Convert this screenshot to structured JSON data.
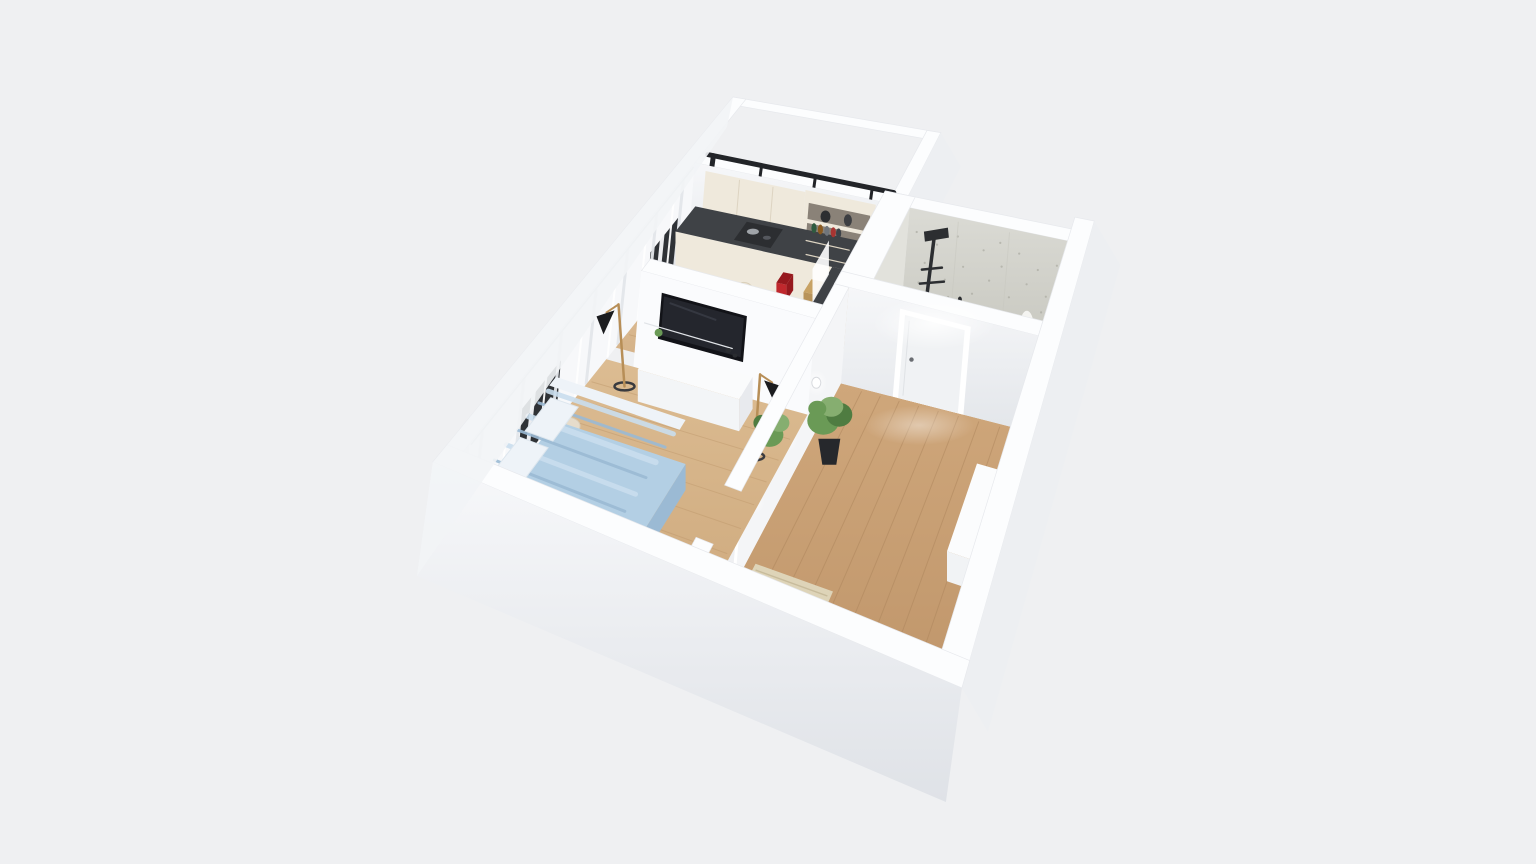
{
  "app": {
    "title": "3D apartment floor plan render",
    "view": "dollhouse-perspective",
    "background": "#eff0f2"
  },
  "scene": {
    "rooms": [
      {
        "id": "balcony",
        "name": "Balcony",
        "items": [
          "glass-wall-frame",
          "window-mullions",
          "balcony-floor",
          "small-dark-object"
        ]
      },
      {
        "id": "kitchen",
        "name": "Kitchen / Dining",
        "items": [
          "upper-cabinets",
          "open-shelf-unit",
          "range-hood",
          "cooktop",
          "red-kettle",
          "spice-rack",
          "dark-countertop",
          "drawer-cabinets",
          "side-counter",
          "dining-table",
          "placemats",
          "dining-chair-left",
          "dining-chair-right",
          "west-window",
          "sheer-curtains"
        ]
      },
      {
        "id": "bathroom",
        "name": "Bathroom",
        "items": [
          "concrete-wall",
          "shower-column",
          "washbasin",
          "toilet",
          "white-decor-branch"
        ]
      },
      {
        "id": "hallway",
        "name": "Hallway / Entry",
        "items": [
          "entry-door",
          "ceiling-light-glow",
          "wall-sconces",
          "potted-plant",
          "ribbed-mat",
          "low-cabinet",
          "warm-lamp"
        ]
      },
      {
        "id": "living-room",
        "name": "Living room / Bedroom",
        "items": [
          "wall-tv",
          "tv-console",
          "console-decor",
          "floor-lamp-left",
          "floor-lamp-right",
          "bed",
          "pillows",
          "pouf",
          "corner-plant",
          "west-windows",
          "sheer-curtains"
        ]
      }
    ]
  },
  "palette": {
    "bg": "#eff0f2",
    "wallCap": "#fcfdfe",
    "wallCapEdge": "#e7e9ed",
    "wallFaceTop": "#f6f7f9",
    "wallFaceBottom": "#e3e6ea",
    "frontTop": "#f7f8fa",
    "frontBottom": "#dfe2e7",
    "eastFace": "#edeff2",
    "floorLiving": "#dcbc92",
    "floorLivingDark": "#cda87c",
    "floorKitchen": "#e0c29b",
    "floorKitchenDark": "#d0ab80",
    "floorHall": "#cfa77b",
    "floorHallDark": "#bd9368",
    "plankLine": "#c09a6e",
    "plankLineHall": "#ad855c",
    "balconyFloor": "#ebedef",
    "bathFloor": "#e9e8e4",
    "counterTop": "#3f4246",
    "cabinetCream": "#efe9dc",
    "cabinetCreamDark": "#ddd4c2",
    "shelfInner": "#8a8278",
    "hoodDark": "#2c2e31",
    "kettleRed": "#c0282d",
    "kettleRedDark": "#96191e",
    "rackWood": "#c8a264",
    "concrete": "#dbdbd5",
    "concreteDark": "#c9c9c1",
    "speckle": "#a8a89e",
    "tvBlack": "#121318",
    "tvScreen": "#24262d",
    "consoleWhite": "#fafbfc",
    "consoleSide": "#e8eaee",
    "bedBlue": "#b3cfe4",
    "bedBlueDark": "#9bbad4",
    "bedBlueLight": "#cadeee",
    "pillowWhite": "#eef3f8",
    "chairCream": "#ebe3d2",
    "chairCreamDark": "#d9cfb9",
    "potDark": "#26282c",
    "plantGreen": "#6a9a56",
    "plantGreenDark": "#4f7c41",
    "plantGreenLight": "#86ae70",
    "matBeige": "#ded4b8",
    "matRib": "#c6ba9a",
    "doorWhite": "#f0f2f4",
    "frameWhite": "#ffffff",
    "handleGray": "#6a6d72",
    "lampBlack": "#1b1c1f",
    "lampWood": "#b78e57",
    "glassFrame": "#222428",
    "warmLight": "#ffdf9e",
    "curtain": "#f7f8fa",
    "curtainShade": "#e4e7eb",
    "windowDark": "#2f3236",
    "shadow": "#b9bcc2"
  }
}
